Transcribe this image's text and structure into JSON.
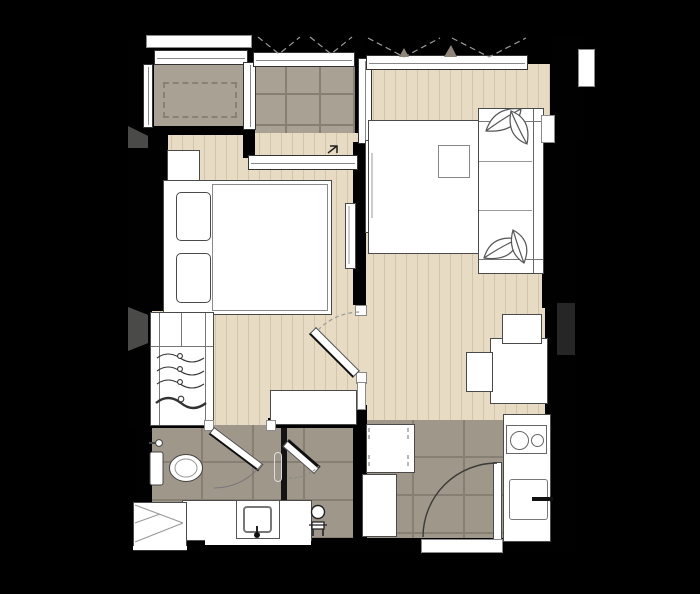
{
  "title": "one-bedroom-condo-unit-floor-plan",
  "canvas": {
    "width": 700,
    "height": 594
  },
  "colors": {
    "background": "#000000",
    "wall": "#010101",
    "wood_floor": "#e7dcc3",
    "wood_plank_line": "#d2c6a8",
    "tile_floor": "#9f978a",
    "tile_grout": "#877f72",
    "balcony_tile": "#a9a294",
    "ledge_floor": "#a9a294",
    "fixture_fill": "#ffffff",
    "fixture_outline": "#4a4a4a",
    "shadow": "#4a4a48",
    "swing_line": "#999999"
  },
  "rooms": [
    {
      "name": "bedroom",
      "floor": "wood-plank",
      "symbols": [
        "double-bed",
        "two-pillows",
        "nightstand",
        "wardrobe-with-clothes-hangers",
        "wall-mounted-tv",
        "low-console",
        "swing-door"
      ]
    },
    {
      "name": "living-area",
      "floor": "wood-plank",
      "symbols": [
        "sofa-with-leaf-cushions",
        "chaise-daybed",
        "side-table-tray",
        "tv-console",
        "flat-tv",
        "dining-table",
        "two-dining-chairs"
      ]
    },
    {
      "name": "balcony",
      "floor": "outdoor-tile",
      "symbols": [
        "sliding-window",
        "casement-swing-marks"
      ]
    },
    {
      "name": "ac-ledge",
      "floor": "concrete",
      "symbols": [
        "ac-condenser-dashed-outline",
        "louver-window"
      ]
    },
    {
      "name": "bathroom",
      "floor": "ceramic-tile",
      "symbols": [
        "toilet",
        "vanity-counter-basin",
        "shower-stall",
        "glass-shower-door",
        "shower-head-figure",
        "swing-door",
        "service-shaft-x-box"
      ]
    },
    {
      "name": "kitchen-entry",
      "floor": "ceramic-tile",
      "symbols": [
        "counter-two-burner-hob",
        "kitchen-sink-with-faucet",
        "refrigerator",
        "washing-machine",
        "entrance-swing-door"
      ]
    }
  ],
  "openings": {
    "exterior_windows": 4,
    "interior_doors": 3,
    "entrance_doors": 1,
    "shower_doors": 1
  }
}
